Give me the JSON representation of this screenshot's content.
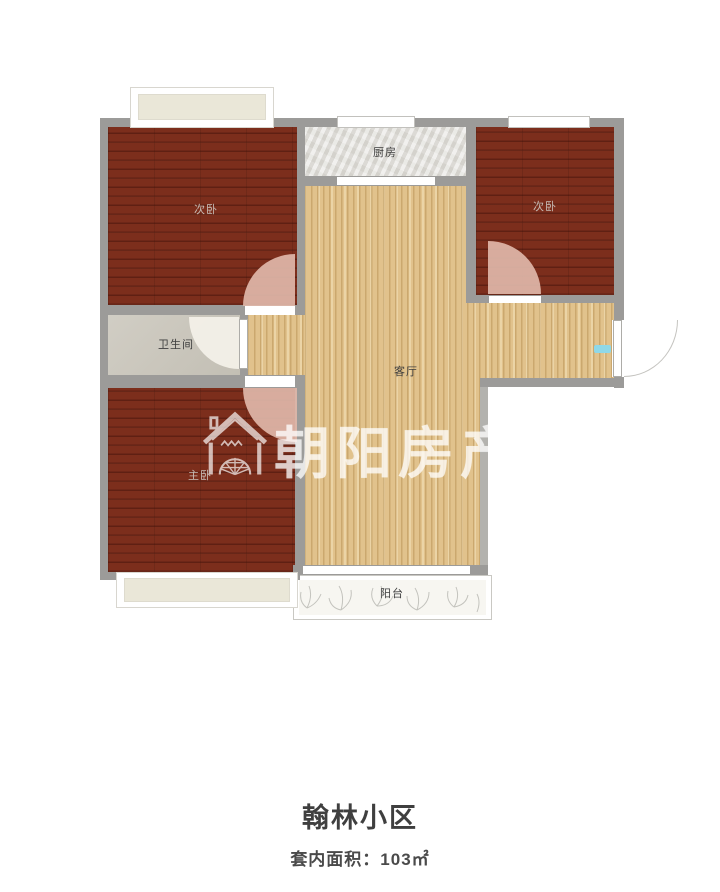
{
  "floorplan": {
    "rooms": {
      "bedroom_left": {
        "label": "次卧"
      },
      "kitchen": {
        "label": "厨房"
      },
      "bedroom_right": {
        "label": "次卧"
      },
      "bathroom": {
        "label": "卫生间"
      },
      "living_room": {
        "label": "客厅"
      },
      "master_bedroom": {
        "label": "主卧"
      },
      "balcony": {
        "label": "阳台"
      }
    },
    "colors": {
      "wall": "#9c9b99",
      "bedroom_floor": "#7c2e1c",
      "living_floor": "#e1c28c",
      "kitchen_floor": "#dcdad5",
      "bathroom_floor": "#c9c5ba",
      "balcony_floor": "#f7f6f1",
      "door_arc": "#e0b7a9",
      "bay_window_fill": "#eae7d8",
      "entry_marker": "#8fd8e8"
    }
  },
  "watermark": {
    "text": "朝阳房产",
    "icon": "house-sun-icon"
  },
  "footer": {
    "title": "翰林小区",
    "area_label": "套内面积：103㎡"
  }
}
